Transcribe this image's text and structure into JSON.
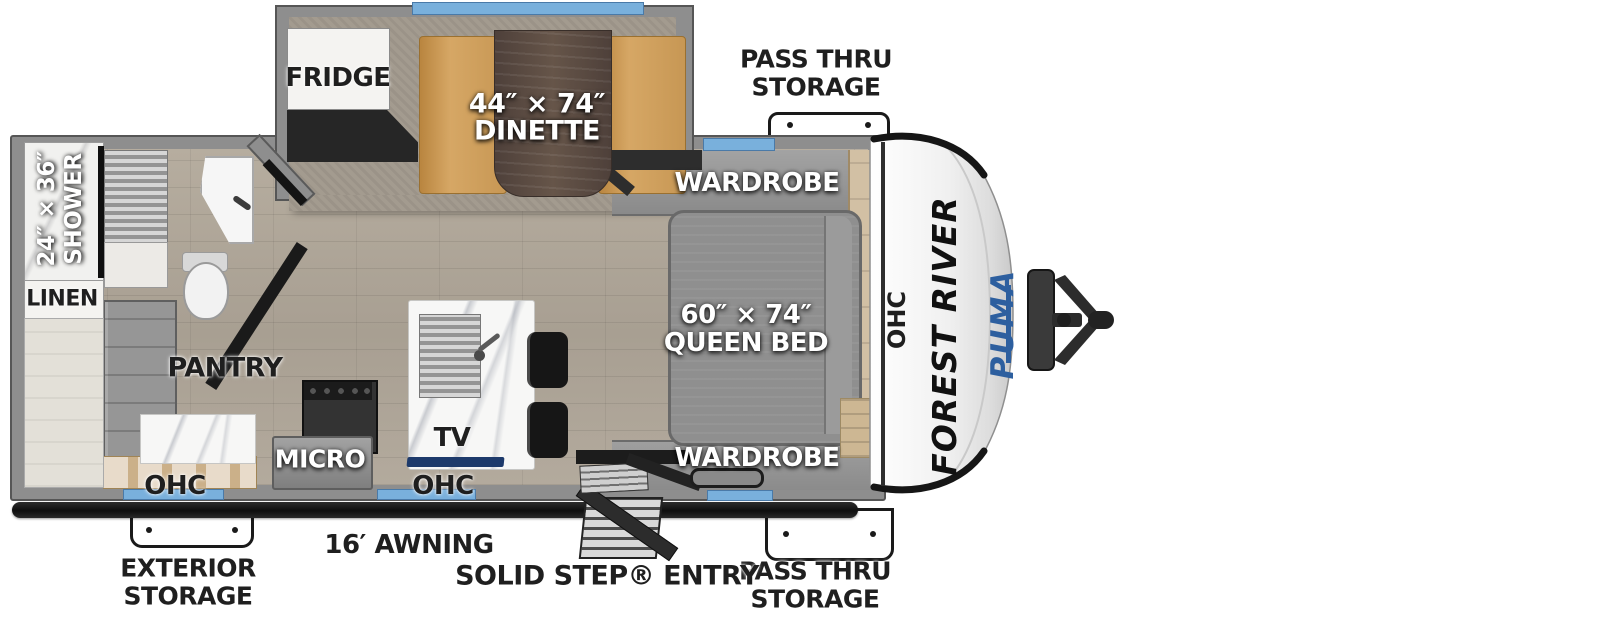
{
  "branding": {
    "manufacturer": "FOREST RIVER",
    "model": "PUMA"
  },
  "exterior_labels": {
    "pass_thru_top": {
      "line1": "PASS THRU",
      "line2": "STORAGE"
    },
    "pass_thru_bottom": {
      "line1": "PASS THRU",
      "line2": "STORAGE"
    },
    "exterior_storage": {
      "line1": "EXTERIOR",
      "line2": "STORAGE"
    },
    "awning": "16′ AWNING",
    "entry": "SOLID STEP® ENTRY"
  },
  "rooms": {
    "fridge": "FRIDGE",
    "dinette": {
      "size": "44″ × 74″",
      "name": "DINETTE"
    },
    "wardrobe_top": "WARDROBE",
    "wardrobe_bottom": "WARDROBE",
    "queen_bed": {
      "size": "60″ × 74″",
      "name": "QUEEN BED"
    },
    "shower": {
      "size": "24″ × 36″",
      "name": "SHOWER"
    },
    "linen": "LINEN",
    "pantry": "PANTRY",
    "micro": "MICRO",
    "tv": "TV",
    "ohc_kitchen_left": "OHC",
    "ohc_kitchen_right": "OHC",
    "ohc_front": "OHC"
  },
  "colors": {
    "wall": "#8e8e8e",
    "wall_outline": "#565656",
    "floor_wood": "#b0a79a",
    "window_blue": "#79b0dc",
    "bench_tan": "#c79754",
    "table_wood": "#57483f",
    "mattress_gray": "#8f8f8f",
    "puma_blue": "#2d5f9f",
    "awning_black": "#151515",
    "label_black": "#1f1f1f",
    "label_white": "#ffffff"
  }
}
